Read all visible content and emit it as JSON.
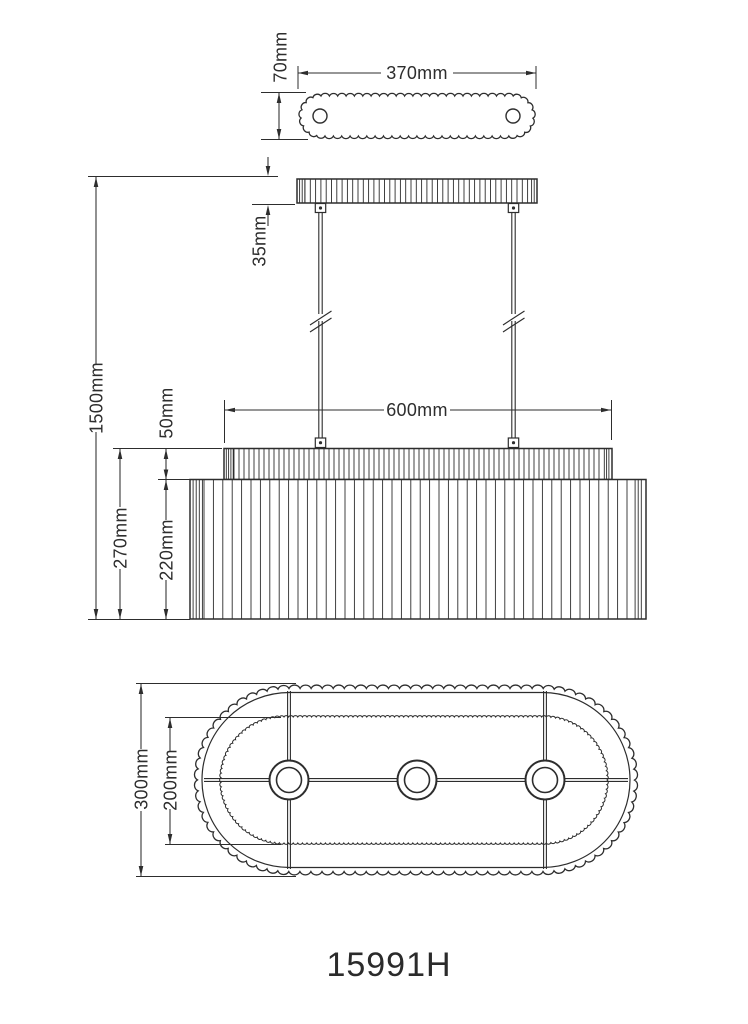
{
  "drawing": {
    "model_number": "15991H",
    "line_color": "#2d2d2d",
    "background_color": "#ffffff",
    "labels": {
      "plate_width": "370mm",
      "plate_depth": "70mm",
      "canopy_height": "35mm",
      "overall_height": "1500mm",
      "shade_top_width": "600mm",
      "shade_top_height": "50mm",
      "shade_total_height": "270mm",
      "shade_body_height": "220mm",
      "shade_depth": "300mm",
      "shade_inner_depth": "200mm"
    }
  }
}
